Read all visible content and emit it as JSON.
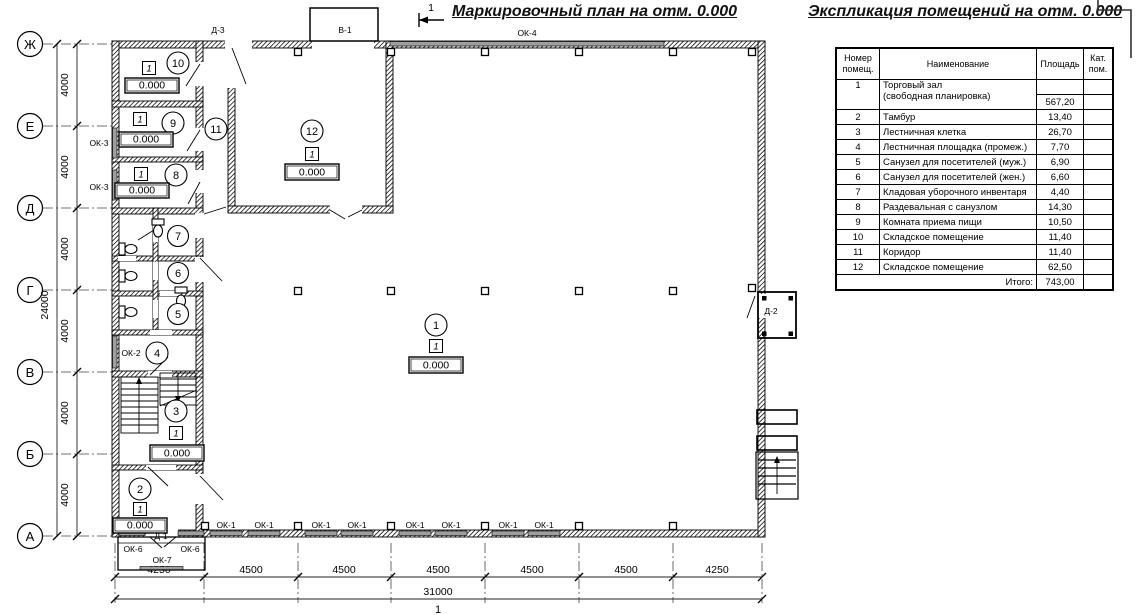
{
  "titles": {
    "plan_title": "Маркировочный план на отм. 0.000",
    "schedule_title": "Экспликация помещений на отм. 0.000",
    "section_mark": "1",
    "bottom_axis_mark": "1"
  },
  "schedule": {
    "headers": {
      "num": "Номер помещ.",
      "name": "Наименование",
      "area": "Площадь",
      "cat": "Кат. пом."
    },
    "rows": [
      {
        "num": "1",
        "name": "Торговый зал",
        "name2": "(свободная планировка)",
        "area": "567,20"
      },
      {
        "num": "2",
        "name": "Тамбур",
        "area": "13,40"
      },
      {
        "num": "3",
        "name": "Лестничная клетка",
        "area": "26,70"
      },
      {
        "num": "4",
        "name": "Лестничная площадка (промеж.)",
        "area": "7,70"
      },
      {
        "num": "5",
        "name": "Санузел для посетителей (муж.)",
        "area": "6,90"
      },
      {
        "num": "6",
        "name": "Санузел для посетителей (жен.)",
        "area": "6,60"
      },
      {
        "num": "7",
        "name": "Кладовая уборочного инвентаря",
        "area": "4,40"
      },
      {
        "num": "8",
        "name": "Раздевальная с санузлом",
        "area": "14,30"
      },
      {
        "num": "9",
        "name": "Комната приема пищи",
        "area": "10,50"
      },
      {
        "num": "10",
        "name": "Складское помещение",
        "area": "11,40"
      },
      {
        "num": "11",
        "name": "Коридор",
        "area": "11,40"
      },
      {
        "num": "12",
        "name": "Складское помещение",
        "area": "62,50"
      }
    ],
    "total_label": "Итого:",
    "total_value": "743,00"
  },
  "axes": {
    "rows": [
      "Ж",
      "Е",
      "Д",
      "Г",
      "В",
      "Б",
      "А"
    ],
    "row_dims": [
      "4000",
      "4000",
      "4000",
      "4000",
      "4000",
      "4000"
    ],
    "row_total": "24000",
    "col_dims": [
      "4250",
      "4500",
      "4500",
      "4500",
      "4500",
      "4500",
      "4250"
    ],
    "col_total": "31000"
  },
  "rooms": [
    {
      "number": "1",
      "floor": "1",
      "elevation": "0.000"
    },
    {
      "number": "2",
      "floor": "1",
      "elevation": "0.000"
    },
    {
      "number": "3",
      "floor": "1",
      "elevation": "0.000"
    },
    {
      "number": "4"
    },
    {
      "number": "5"
    },
    {
      "number": "6"
    },
    {
      "number": "7"
    },
    {
      "number": "8",
      "floor": "1",
      "elevation": "0.000"
    },
    {
      "number": "9",
      "floor": "1",
      "elevation": "0.000"
    },
    {
      "number": "10",
      "floor": "1",
      "elevation": "0.000"
    },
    {
      "number": "11"
    },
    {
      "number": "12",
      "floor": "1",
      "elevation": "0.000"
    }
  ],
  "labels": {
    "ok1": "ОК-1",
    "ok2": "ОК-2",
    "ok3": "ОК-3",
    "ok4": "ОК-4",
    "ok6": "ОК-6",
    "ok7": "ОК-7",
    "d1": "Д-1",
    "d2": "Д-2",
    "d3": "Д-3",
    "v1": "В-1"
  }
}
